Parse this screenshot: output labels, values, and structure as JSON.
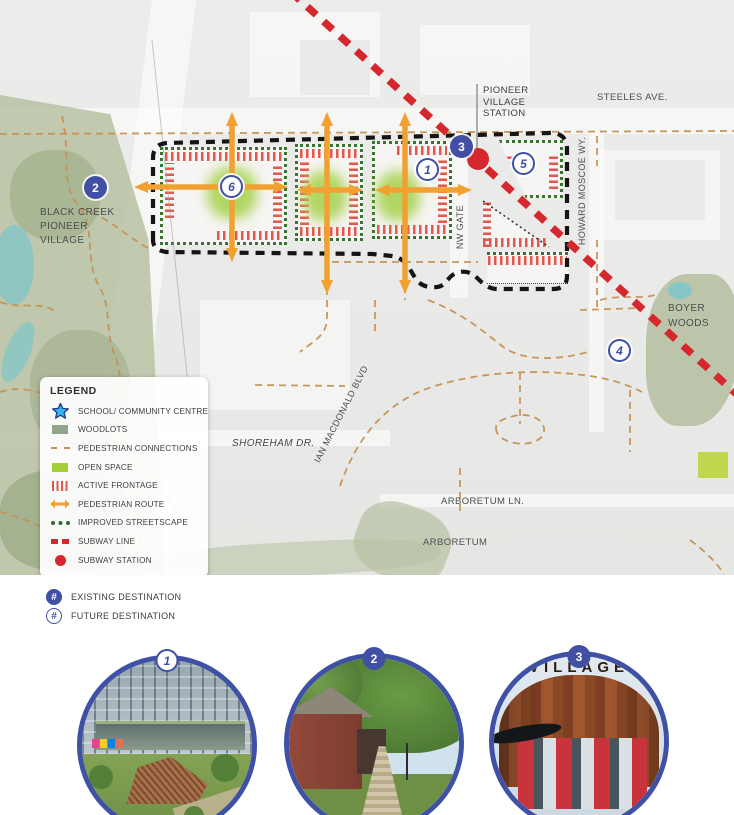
{
  "map": {
    "labels": {
      "station": "PIONEER\nVILLAGE\nSTATION",
      "steeles": "STEELES AVE.",
      "black_creek": "BLACK CREEK\nPIONEER\nVILLAGE",
      "boyer_woods": "BOYER\nWOODS",
      "shoreham": "SHOREHAM DR.",
      "ian_macdonald": "IAN MACDONALD BLVD",
      "arboretum_ln": "ARBORETUM LN.",
      "arboretum": "ARBORETUM",
      "nw_gate": "NW GATE",
      "howard_moscoe": "HOWARD MOSCOE WY."
    },
    "markers": [
      {
        "number": "1",
        "type": "future"
      },
      {
        "number": "2",
        "type": "existing"
      },
      {
        "number": "3",
        "type": "existing"
      },
      {
        "number": "4",
        "type": "future"
      },
      {
        "number": "5",
        "type": "future"
      },
      {
        "number": "6",
        "type": "future"
      }
    ]
  },
  "legend": {
    "title": "LEGEND",
    "items": [
      {
        "icon": "star-icon",
        "label": "SCHOOL/ COMMUNITY CENTRE"
      },
      {
        "icon": "woodlots-swatch",
        "label": "WOODLOTS"
      },
      {
        "icon": "dashed-line-icon",
        "label": "PEDESTRIAN CONNECTIONS"
      },
      {
        "icon": "open-space-swatch",
        "label": "OPEN SPACE"
      },
      {
        "icon": "striped-swatch",
        "label": "ACTIVE FRONTAGE"
      },
      {
        "icon": "double-arrow-icon",
        "label": "PEDESTRIAN ROUTE"
      },
      {
        "icon": "dotted-line-icon",
        "label": "IMPROVED STREETSCAPE"
      },
      {
        "icon": "subway-dash-icon",
        "label": "SUBWAY LINE"
      },
      {
        "icon": "subway-dot-icon",
        "label": "SUBWAY STATION"
      }
    ]
  },
  "destination_key": {
    "existing": {
      "symbol": "#",
      "label": "EXISTING DESTINATION"
    },
    "future": {
      "symbol": "#",
      "label": "FUTURE DESTINATION"
    }
  },
  "photos": [
    {
      "badge": "1",
      "type": "future",
      "subject": "campus buildings with public open space"
    },
    {
      "badge": "2",
      "type": "existing",
      "subject": "Black Creek Pioneer Village boardwalk"
    },
    {
      "badge": "3",
      "type": "existing",
      "subject": "Pioneer Village Station entrance",
      "building_text": "VILLAGE"
    }
  ],
  "colors": {
    "destination_blue": "#4150a5",
    "subway_red": "#d7272e",
    "pedestrian_orange": "#f0a132",
    "connection_tan": "#c49254",
    "streetscape_green": "#2f6e31",
    "open_space_green": "#a6ce39",
    "woodlots_green": "#93a48b",
    "frontage_red": "#e2584e",
    "school_star_cyan": "#35b5e8"
  }
}
